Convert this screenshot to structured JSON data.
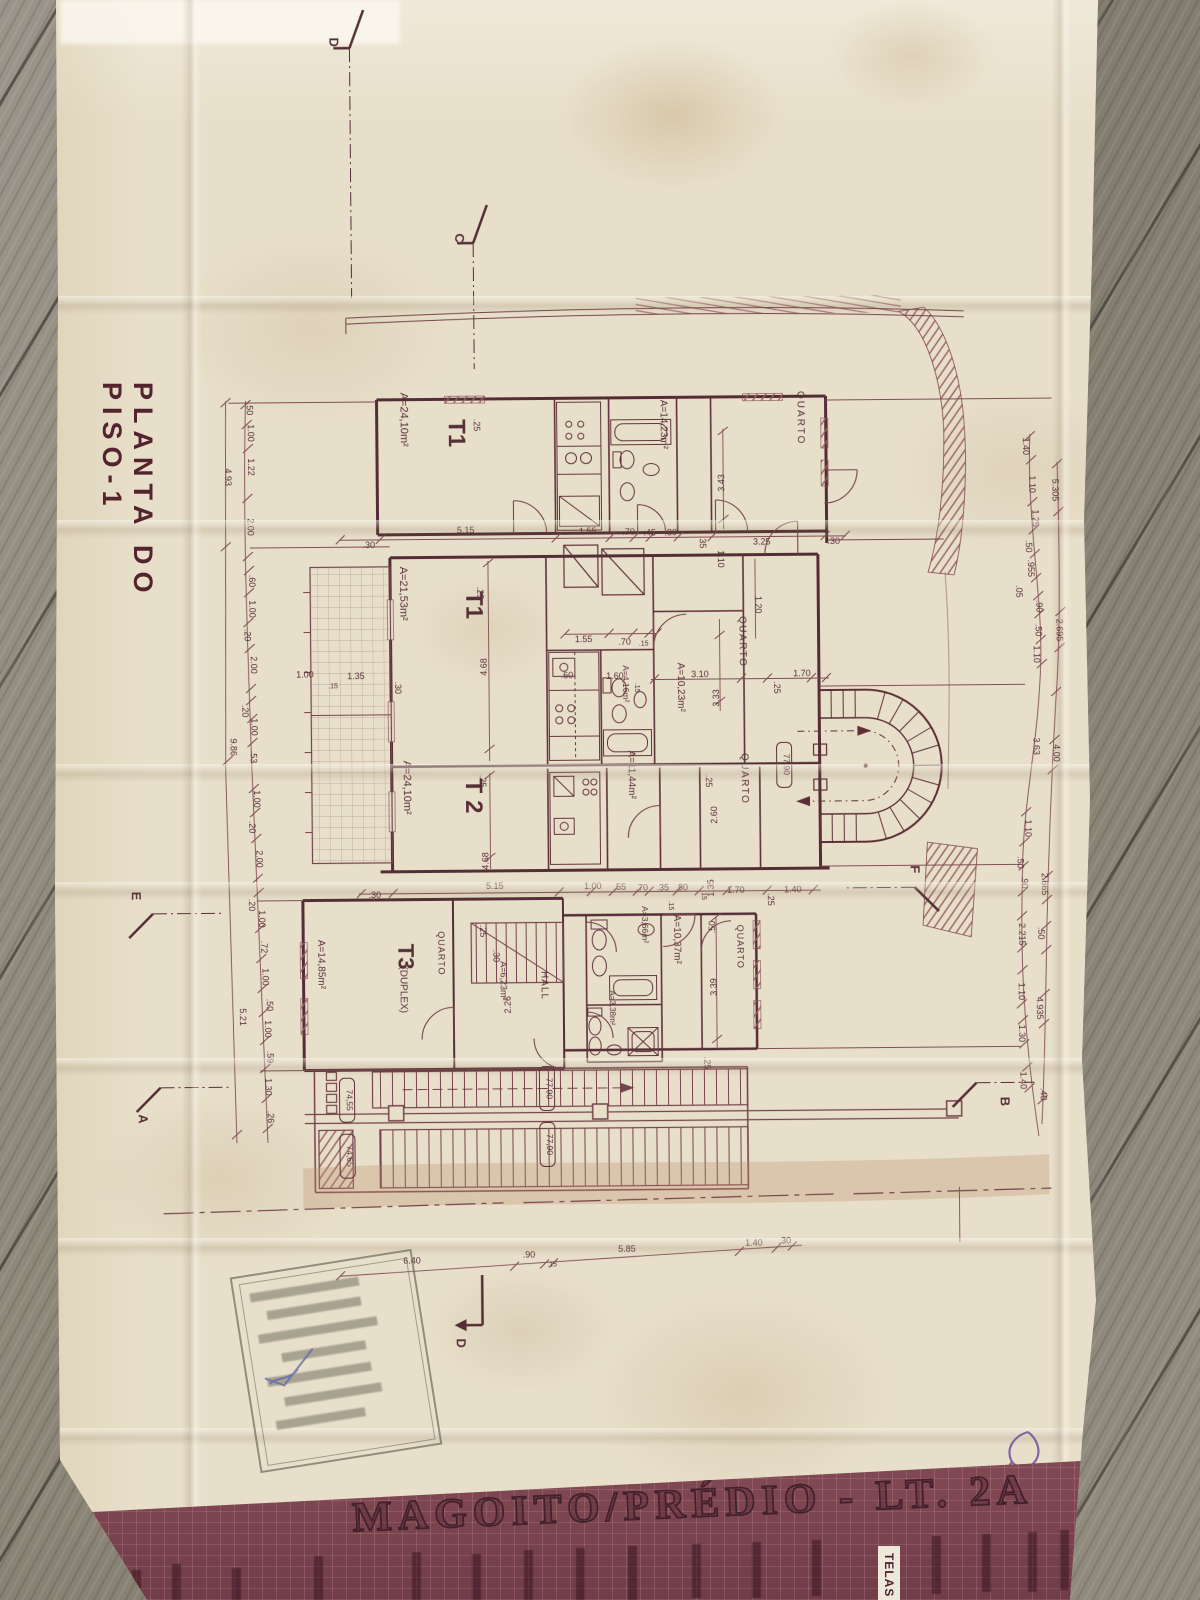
{
  "palette": {
    "paper": "#e8dfca",
    "ink": "#52262f",
    "ink_light": "#7a454d",
    "band": "#7c4550",
    "wood": "#8d8779",
    "earth": "#bf8a64",
    "stamp_grey": "#6b685f",
    "pen_blue": "#4a58a8",
    "pen_purple": "#7050a0"
  },
  "paper": {
    "plan_title": "PLANTA DO PISO-1"
  },
  "title_block": {
    "project_title": "MAGOITO/PRÉDIO - LT. 2A",
    "column_label": "TELAS"
  },
  "plan": {
    "labels": [
      {
        "t": "T1",
        "x": 452,
        "y": 432,
        "r": 90,
        "s": 24,
        "b": true
      },
      {
        "t": "A=24,10m²",
        "x": 404,
        "y": 418,
        "r": 90,
        "s": 11
      },
      {
        "t": "A=14,23m²",
        "x": 664,
        "y": 425,
        "r": 90,
        "s": 10
      },
      {
        "t": "QUARTO",
        "x": 801,
        "y": 420,
        "r": 90,
        "s": 10,
        "ls": 2
      },
      {
        "t": "T1",
        "x": 468,
        "y": 604,
        "r": 90,
        "s": 24,
        "b": true
      },
      {
        "t": "A=21,53m²",
        "x": 402,
        "y": 592,
        "r": 90,
        "s": 11
      },
      {
        "t": "A=4,16m²",
        "x": 624,
        "y": 684,
        "r": 90,
        "s": 8.5
      },
      {
        "t": "QUARTO",
        "x": 741,
        "y": 643,
        "r": 90,
        "s": 10,
        "ls": 1.5
      },
      {
        "t": "A=10,23m²",
        "x": 679,
        "y": 688,
        "r": 90,
        "s": 10
      },
      {
        "t": "QUARTO",
        "x": 742,
        "y": 780,
        "r": 90,
        "s": 10,
        "ls": 1.5
      },
      {
        "t": "T 2",
        "x": 466,
        "y": 795,
        "r": 90,
        "s": 24,
        "b": true
      },
      {
        "t": "A=24,10m²",
        "x": 404,
        "y": 786,
        "r": 90,
        "s": 11
      },
      {
        "t": "A=11,44m²",
        "x": 629,
        "y": 775,
        "r": 90,
        "s": 10
      },
      {
        "t": "T3",
        "x": 397,
        "y": 955,
        "r": 90,
        "s": 22,
        "b": true
      },
      {
        "t": "(DUPLEX)",
        "x": 399,
        "y": 988,
        "r": 90,
        "s": 10
      },
      {
        "t": "QUARTO",
        "x": 437,
        "y": 952,
        "r": 90,
        "s": 9,
        "ls": 1
      },
      {
        "t": "A=14,85m²",
        "x": 317,
        "y": 962,
        "r": 90,
        "s": 10
      },
      {
        "t": "A=6,23m²",
        "x": 499,
        "y": 980,
        "r": 90,
        "s": 9
      },
      {
        "t": "HALL",
        "x": 540,
        "y": 985,
        "r": 90,
        "s": 10,
        "ls": 1
      },
      {
        "t": "A=3,66m²",
        "x": 641,
        "y": 925,
        "r": 90,
        "s": 8.5
      },
      {
        "t": "A=10,37m²",
        "x": 673,
        "y": 940,
        "r": 90,
        "s": 10
      },
      {
        "t": "QUARTO",
        "x": 736,
        "y": 948,
        "r": 90,
        "s": 9,
        "ls": 1
      },
      {
        "t": "A=3,38m²",
        "x": 608,
        "y": 1008,
        "r": 90,
        "s": 8
      }
    ],
    "dims": [
      {
        "t": ".50",
        "x": 250,
        "y": 406,
        "r": 90
      },
      {
        "t": "1.00",
        "x": 251,
        "y": 430,
        "r": 90
      },
      {
        "t": "1.22",
        "x": 251,
        "y": 464,
        "r": 90
      },
      {
        "t": "2.00",
        "x": 250,
        "y": 524,
        "r": 90
      },
      {
        "t": ".60",
        "x": 251,
        "y": 578,
        "r": 90
      },
      {
        "t": "1.00",
        "x": 251,
        "y": 606,
        "r": 90
      },
      {
        "t": ".20",
        "x": 246,
        "y": 632,
        "r": 90
      },
      {
        "t": "2.00",
        "x": 252,
        "y": 662,
        "r": 90
      },
      {
        "t": ".20",
        "x": 243,
        "y": 708,
        "r": 90
      },
      {
        "t": "1.00",
        "x": 252,
        "y": 724,
        "r": 90
      },
      {
        "t": ".53",
        "x": 251,
        "y": 754,
        "r": 90
      },
      {
        "t": "1.00",
        "x": 254,
        "y": 796,
        "r": 90
      },
      {
        "t": ".20",
        "x": 249,
        "y": 824,
        "r": 90
      },
      {
        "t": "2.00",
        "x": 256,
        "y": 856,
        "r": 90
      },
      {
        "t": ".20",
        "x": 248,
        "y": 902,
        "r": 90
      },
      {
        "t": "1.00",
        "x": 258,
        "y": 916,
        "r": 90
      },
      {
        "t": ".72",
        "x": 260,
        "y": 944,
        "r": 90
      },
      {
        "t": "1.00",
        "x": 261,
        "y": 974,
        "r": 90
      },
      {
        "t": ".50",
        "x": 265,
        "y": 1002,
        "r": 90
      },
      {
        "t": "1.00",
        "x": 263,
        "y": 1026,
        "r": 90
      },
      {
        "t": ".59",
        "x": 265,
        "y": 1054,
        "r": 90
      },
      {
        "t": "1.30",
        "x": 263,
        "y": 1084,
        "r": 90
      },
      {
        "t": ".26",
        "x": 265,
        "y": 1114,
        "r": 90
      },
      {
        "t": "4.93",
        "x": 228,
        "y": 474,
        "r": 90
      },
      {
        "t": "9.86",
        "x": 231,
        "y": 744,
        "r": 90
      },
      {
        "t": "5.21",
        "x": 238,
        "y": 1014,
        "r": 90
      },
      {
        "t": "1.40",
        "x": 1026,
        "y": 450,
        "r": 90
      },
      {
        "t": "1.10",
        "x": 1032,
        "y": 488,
        "r": 90
      },
      {
        "t": "1.25",
        "x": 1035,
        "y": 522,
        "r": 90
      },
      {
        "t": ".50",
        "x": 1028,
        "y": 550,
        "r": 90
      },
      {
        "t": ".955",
        "x": 1030,
        "y": 572,
        "r": 90
      },
      {
        "t": ".05",
        "x": 1018,
        "y": 595,
        "r": 90
      },
      {
        "t": ".90",
        "x": 1038,
        "y": 610,
        "r": 90
      },
      {
        "t": ".50",
        "x": 1037,
        "y": 634,
        "r": 90
      },
      {
        "t": "1.10",
        "x": 1035,
        "y": 658,
        "r": 90
      },
      {
        "t": "5.305",
        "x": 1055,
        "y": 494,
        "r": 90
      },
      {
        "t": "2.695",
        "x": 1058,
        "y": 634,
        "r": 90
      },
      {
        "t": "3.63",
        "x": 1034,
        "y": 750,
        "r": 90
      },
      {
        "t": "4.00",
        "x": 1054,
        "y": 757,
        "r": 90
      },
      {
        "t": "1.10",
        "x": 1025,
        "y": 832,
        "r": 90
      },
      {
        "t": ".50",
        "x": 1017,
        "y": 866,
        "r": 90
      },
      {
        "t": ".90",
        "x": 1021,
        "y": 886,
        "r": 90
      },
      {
        "t": "2.665",
        "x": 1041,
        "y": 888,
        "r": 90
      },
      {
        "t": "2.215",
        "x": 1018,
        "y": 938,
        "r": 90
      },
      {
        "t": ".50",
        "x": 1037,
        "y": 937,
        "r": 90
      },
      {
        "t": "1.10",
        "x": 1017,
        "y": 995,
        "r": 90
      },
      {
        "t": "4.935",
        "x": 1035,
        "y": 1012,
        "r": 90
      },
      {
        "t": "1.30",
        "x": 1017,
        "y": 1037,
        "r": 90
      },
      {
        "t": "1.40",
        "x": 1018,
        "y": 1084,
        "r": 90
      },
      {
        "t": ".40",
        "x": 1038,
        "y": 1098,
        "r": 90
      },
      {
        "t": ".30",
        "x": 371,
        "y": 546
      },
      {
        "t": "5.15",
        "x": 468,
        "y": 532
      },
      {
        "t": "1.55",
        "x": 590,
        "y": 534
      },
      {
        "t": ".70",
        "x": 631,
        "y": 535
      },
      {
        "t": ".45",
        "x": 652,
        "y": 536
      },
      {
        "t": ".80",
        "x": 673,
        "y": 536
      },
      {
        "t": "3.25",
        "x": 764,
        "y": 546
      },
      {
        "t": ".30",
        "x": 836,
        "y": 546
      },
      {
        "t": ".25",
        "x": 477,
        "y": 424,
        "r": 90
      },
      {
        "t": ".35",
        "x": 702,
        "y": 543,
        "r": 90
      },
      {
        "t": "1.10",
        "x": 720,
        "y": 560,
        "r": 90
      },
      {
        "t": "1.20",
        "x": 757,
        "y": 606,
        "r": 90
      },
      {
        "t": "3.43",
        "x": 727,
        "y": 484,
        "r": -90
      },
      {
        "t": "1.55",
        "x": 585,
        "y": 642
      },
      {
        "t": ".70",
        "x": 626,
        "y": 645
      },
      {
        "t": ".15",
        "x": 645,
        "y": 646,
        "s": 7
      },
      {
        "t": ".60",
        "x": 568,
        "y": 678
      },
      {
        "t": "1.60",
        "x": 616,
        "y": 679
      },
      {
        "t": "3.10",
        "x": 701,
        "y": 678
      },
      {
        "t": "1.70",
        "x": 803,
        "y": 678
      },
      {
        "t": "1.00",
        "x": 306,
        "y": 675
      },
      {
        "t": "1.35",
        "x": 357,
        "y": 677
      },
      {
        "t": ".15",
        "x": 334,
        "y": 686,
        "s": 7
      },
      {
        "t": ".15",
        "x": 636,
        "y": 688,
        "r": 90,
        "s": 7
      },
      {
        "t": ".25",
        "x": 775,
        "y": 689,
        "r": 90
      },
      {
        "t": ".25",
        "x": 706,
        "y": 782,
        "r": 90
      },
      {
        "t": ".25",
        "x": 479,
        "y": 592,
        "r": 90
      },
      {
        "t": ".30",
        "x": 396,
        "y": 686,
        "r": 90
      },
      {
        "t": "3.33",
        "x": 720,
        "y": 699,
        "r": -90
      },
      {
        "t": "2.60",
        "x": 717,
        "y": 816,
        "r": -90
      },
      {
        "t": "4.68",
        "x": 488,
        "y": 666,
        "r": -90
      },
      {
        "t": "4.68",
        "x": 488,
        "y": 860,
        "r": -90
      },
      {
        "t": "1.35",
        "x": 713,
        "y": 889,
        "r": -90
      },
      {
        "t": ".25",
        "x": 480,
        "y": 780,
        "r": 90
      },
      {
        "t": ".15",
        "x": 701,
        "y": 896,
        "r": 90,
        "s": 7
      },
      {
        "t": ".25",
        "x": 767,
        "y": 901,
        "r": 90
      },
      {
        "t": ".30",
        "x": 374,
        "y": 896
      },
      {
        "t": "5.15",
        "x": 494,
        "y": 888
      },
      {
        "t": "1.00",
        "x": 592,
        "y": 889
      },
      {
        "t": ".55",
        "x": 619,
        "y": 890
      },
      {
        "t": ".70",
        "x": 641,
        "y": 891
      },
      {
        "t": ".35",
        "x": 662,
        "y": 891
      },
      {
        "t": ".80",
        "x": 681,
        "y": 891
      },
      {
        "t": "1.70",
        "x": 735,
        "y": 894
      },
      {
        "t": "1.40",
        "x": 792,
        "y": 894
      },
      {
        "t": ".25",
        "x": 479,
        "y": 930,
        "r": 90
      },
      {
        "t": ".30",
        "x": 492,
        "y": 955,
        "r": 90
      },
      {
        "t": ".25",
        "x": 702,
        "y": 1064,
        "r": 90
      },
      {
        "t": ".15",
        "x": 668,
        "y": 906,
        "r": 90,
        "s": 7
      },
      {
        "t": "2.26",
        "x": 509,
        "y": 1004,
        "r": -90
      },
      {
        "t": ".50",
        "x": 714,
        "y": 928,
        "r": -90
      },
      {
        "t": "3.39",
        "x": 715,
        "y": 988,
        "r": -90
      },
      {
        "t": "6.40",
        "x": 408,
        "y": 1262
      },
      {
        "t": ".90",
        "x": 525,
        "y": 1257
      },
      {
        "t": ".15",
        "x": 548,
        "y": 1266,
        "s": 7
      },
      {
        "t": "5.85",
        "x": 623,
        "y": 1252
      },
      {
        "t": "1.40",
        "x": 750,
        "y": 1247
      },
      {
        "t": ".30",
        "x": 781,
        "y": 1245
      }
    ],
    "levels": [
      {
        "t": "77,90",
        "x": 784,
        "y": 766,
        "r": 90
      },
      {
        "t": "77,90",
        "x": 544,
        "y": 1088,
        "r": 90
      },
      {
        "t": "77,90",
        "x": 544,
        "y": 1144,
        "r": 90
      },
      {
        "t": "74,55",
        "x": 344,
        "y": 1098,
        "r": 90
      },
      {
        "t": "74,65",
        "x": 344,
        "y": 1154,
        "r": 90
      }
    ],
    "sections": [
      {
        "t": "D",
        "x": 336,
        "y": 40,
        "r": 90
      },
      {
        "t": "C",
        "x": 460,
        "y": 237,
        "r": 90
      },
      {
        "t": "E",
        "x": 131,
        "y": 892,
        "r": 90
      },
      {
        "t": "F",
        "x": 910,
        "y": 872,
        "r": 90
      },
      {
        "t": "A",
        "x": 136,
        "y": 1115,
        "r": 90
      },
      {
        "t": "B",
        "x": 998,
        "y": 1105,
        "r": 90
      },
      {
        "t": "D",
        "x": 452,
        "y": 1342,
        "r": 90
      }
    ]
  }
}
